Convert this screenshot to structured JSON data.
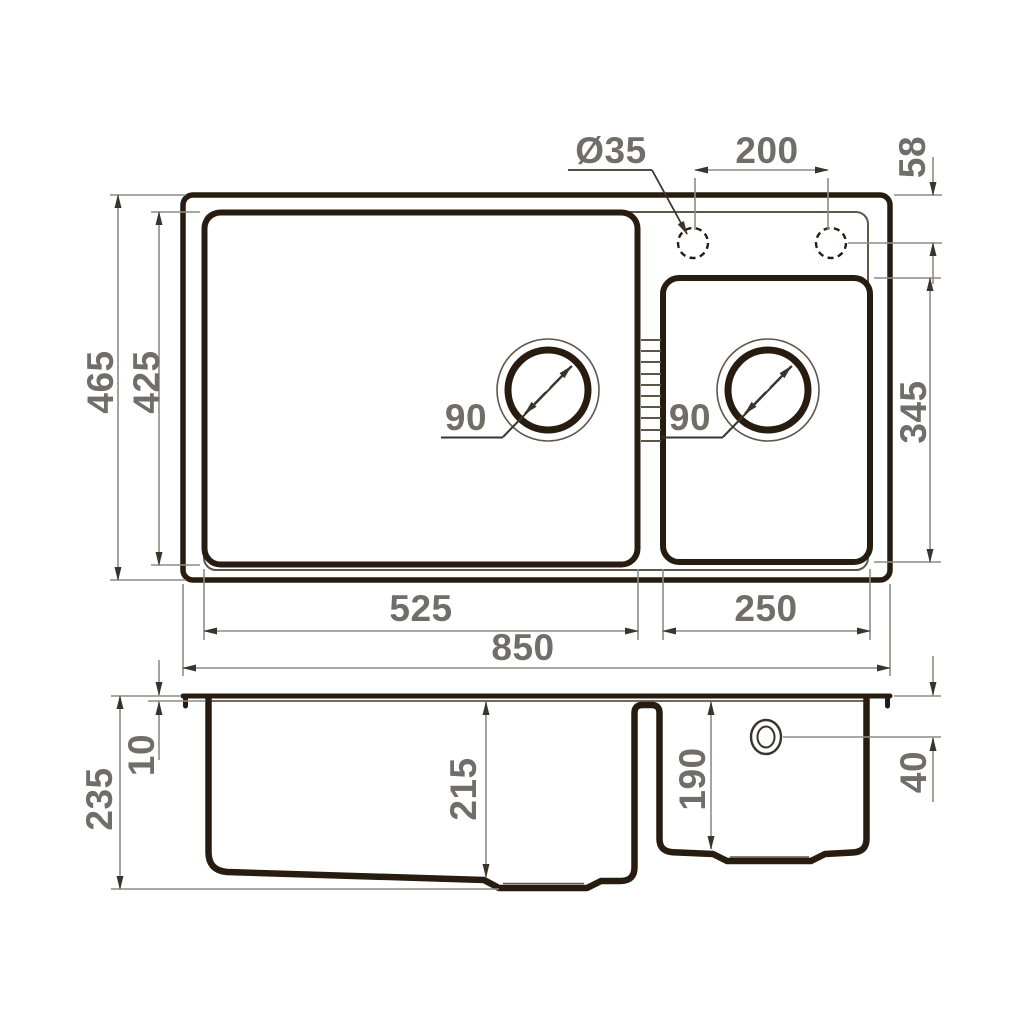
{
  "colors": {
    "line_dark": "#281c10",
    "line_medium": "#5f564a",
    "dim_line": "#8f8b86",
    "arrow": "#3a342c",
    "label": "#716d68",
    "background": "#ffffff"
  },
  "top_view": {
    "labels": {
      "overall_depth": "465",
      "bowl_depth": "425",
      "faucet_hole_diameter": "Ø35",
      "faucet_hole_spacing": "200",
      "faucet_hole_edge_offset": "58",
      "right_bowl_depth": "345",
      "left_drain_diameter": "90",
      "right_drain_diameter": "90",
      "left_bowl_width": "525",
      "right_bowl_width": "250",
      "overall_width": "850"
    }
  },
  "section_view": {
    "labels": {
      "overall_height": "235",
      "rim_height": "10",
      "left_bowl_depth": "215",
      "right_bowl_depth": "190",
      "overflow_offset": "40"
    }
  }
}
